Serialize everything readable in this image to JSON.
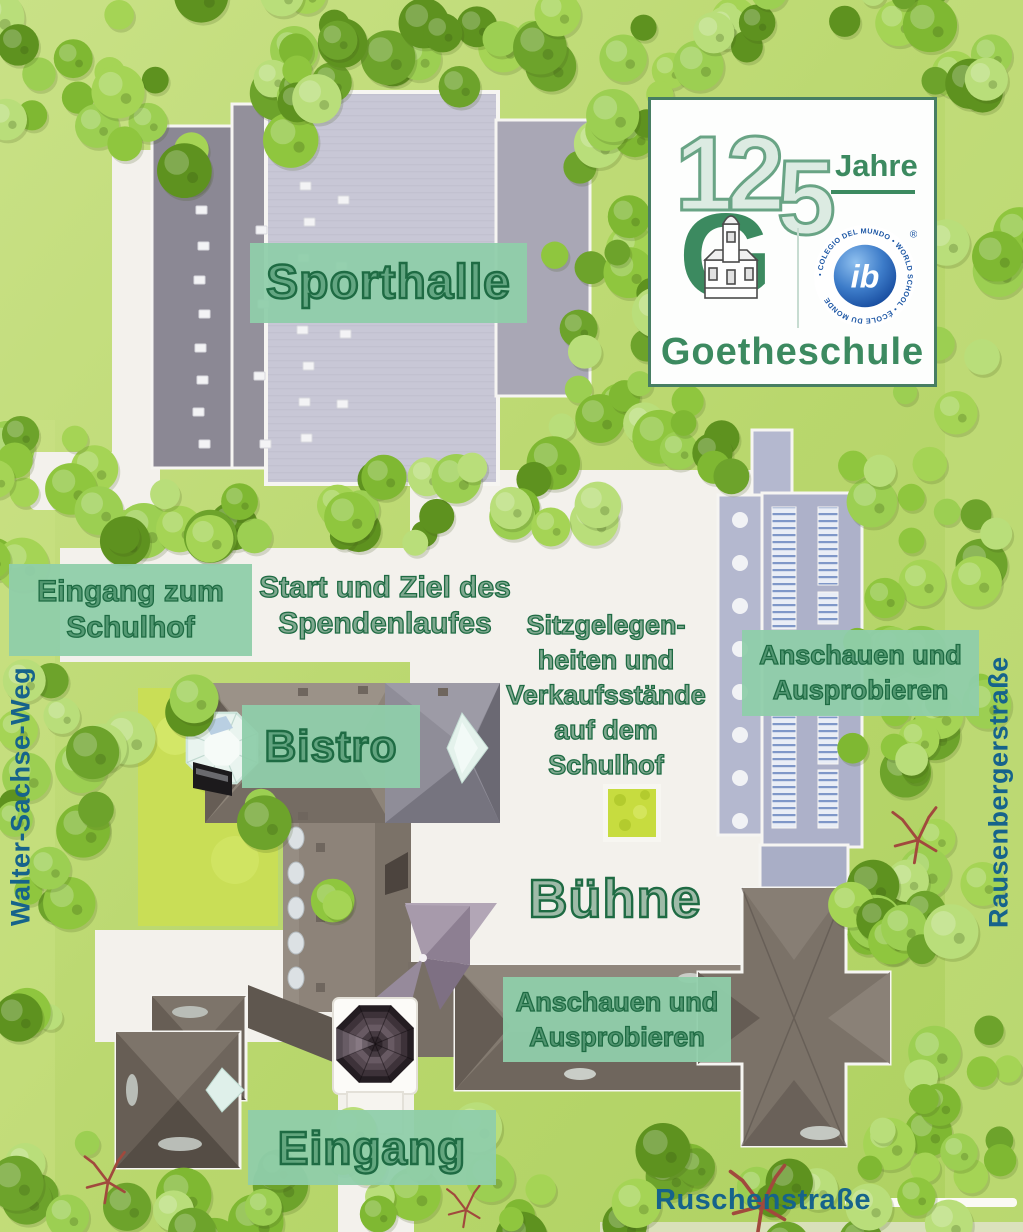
{
  "map": {
    "badge": {
      "years_head": "12",
      "years_tail": "5",
      "years_label": "Jahre",
      "g_monogram": "G",
      "ib_text": "ib",
      "ib_ring_text": "• COLEGIO DEL MUNDO • WORLD SCHOOL • ÉCOLE DU MONDE",
      "ib_registered": "®",
      "school_name": "Goetheschule"
    },
    "streets": {
      "west": "Walter-Sachse-Weg",
      "east": "Rausenbergerstraße",
      "south": "Ruschenstraße"
    },
    "labels": {
      "sporthalle": "Sporthalle",
      "entrance_courtyard": [
        "Eingang zum",
        "Schulhof"
      ],
      "start_finish": [
        "Start und Ziel des",
        "Spendenlaufes"
      ],
      "seating": [
        "Sitzgelegen-",
        "heiten und",
        "Verkaufsstände",
        "auf dem",
        "Schulhof"
      ],
      "look_try": [
        "Anschauen und",
        "Ausprobieren"
      ],
      "bistro": "Bistro",
      "stage": "Bühne",
      "entrance": "Eingang"
    },
    "colors": {
      "grass": "#bcd96f",
      "courtyard": "#f3f1ec",
      "label_box": "#8fceaa",
      "label_text": "#1e6b43",
      "street_text": "#16638b",
      "logo_green": "#3c8a60",
      "ib_blue": "#1d57a5"
    }
  }
}
